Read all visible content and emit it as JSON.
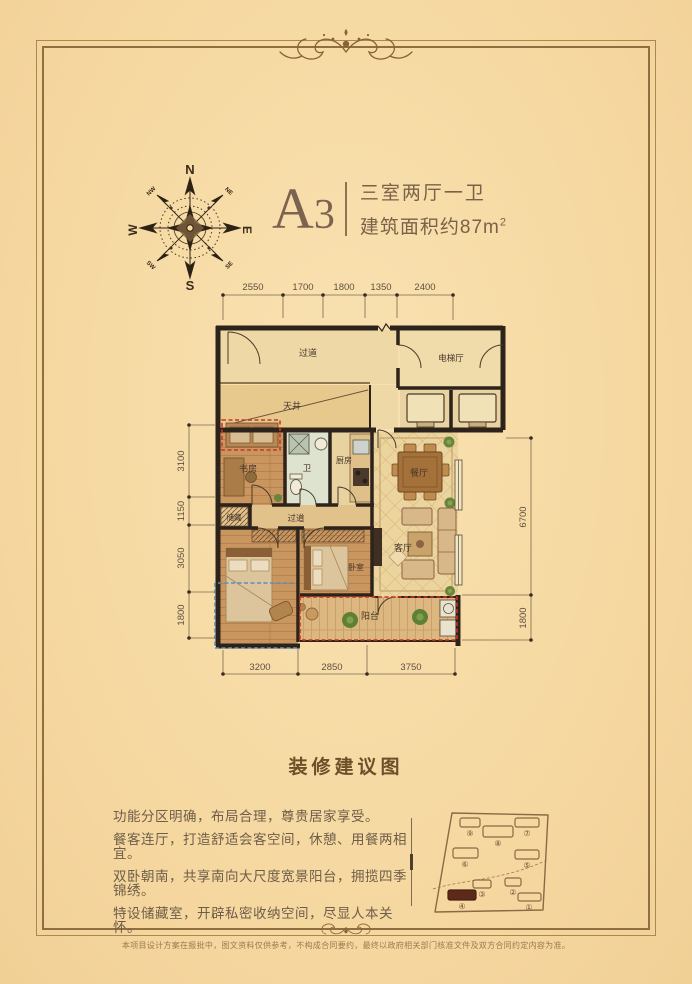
{
  "header": {
    "unit_letter": "A",
    "unit_number": "3",
    "spec_rooms": "三室两厅一卫",
    "spec_area": "建筑面积约87m",
    "spec_area_sup": "2"
  },
  "compass": {
    "n": "N",
    "s": "S",
    "e": "E",
    "w": "W",
    "ne": "NE",
    "nw": "NW",
    "se": "SE",
    "sw": "SW"
  },
  "floorplan": {
    "rooms": {
      "corridor": "过道",
      "elevator_hall": "电梯厅",
      "lightwell": "天井",
      "study": "书房",
      "bath": "卫",
      "kitchen": "厨房",
      "dining": "餐厅",
      "storage": "储藏",
      "hallway": "过道",
      "bedroom": "卧室",
      "living": "客厅",
      "balcony": "阳台"
    },
    "dims_top": [
      "2550",
      "1700",
      "1800",
      "1350",
      "2400"
    ],
    "dims_left": [
      "3100",
      "1150",
      "3050",
      "1800"
    ],
    "dims_right": [
      "6700",
      "1800"
    ],
    "dims_bottom": [
      "3200",
      "2850",
      "3750"
    ]
  },
  "section_title": "装修建议图",
  "features": [
    "功能分区明确，布局合理，尊贵居家享受。",
    "餐客连厅，打造舒适会客空间，休憩、用餐两相宜。",
    "双卧朝南，共享南向大尺度宽景阳台，拥揽四季锦绣。",
    "特设储藏室，开辟私密收纳空间，尽显人本关怀。"
  ],
  "keyplan": {
    "labels": [
      "⑨",
      "⑧",
      "⑦",
      "⑥",
      "⑤",
      "③",
      "②",
      "④",
      "①"
    ]
  },
  "footer": {
    "disclaimer": "本项目设计方案在报批中，图文资料仅供参考，不构成合同要约，最终以政府相关部门核准文件及双方合同约定内容为准。"
  },
  "colors": {
    "accent_red": "#cc3426",
    "accent_blue": "#5f8fb8",
    "wall": "#2d231a",
    "frame": "#8f6f3f"
  }
}
